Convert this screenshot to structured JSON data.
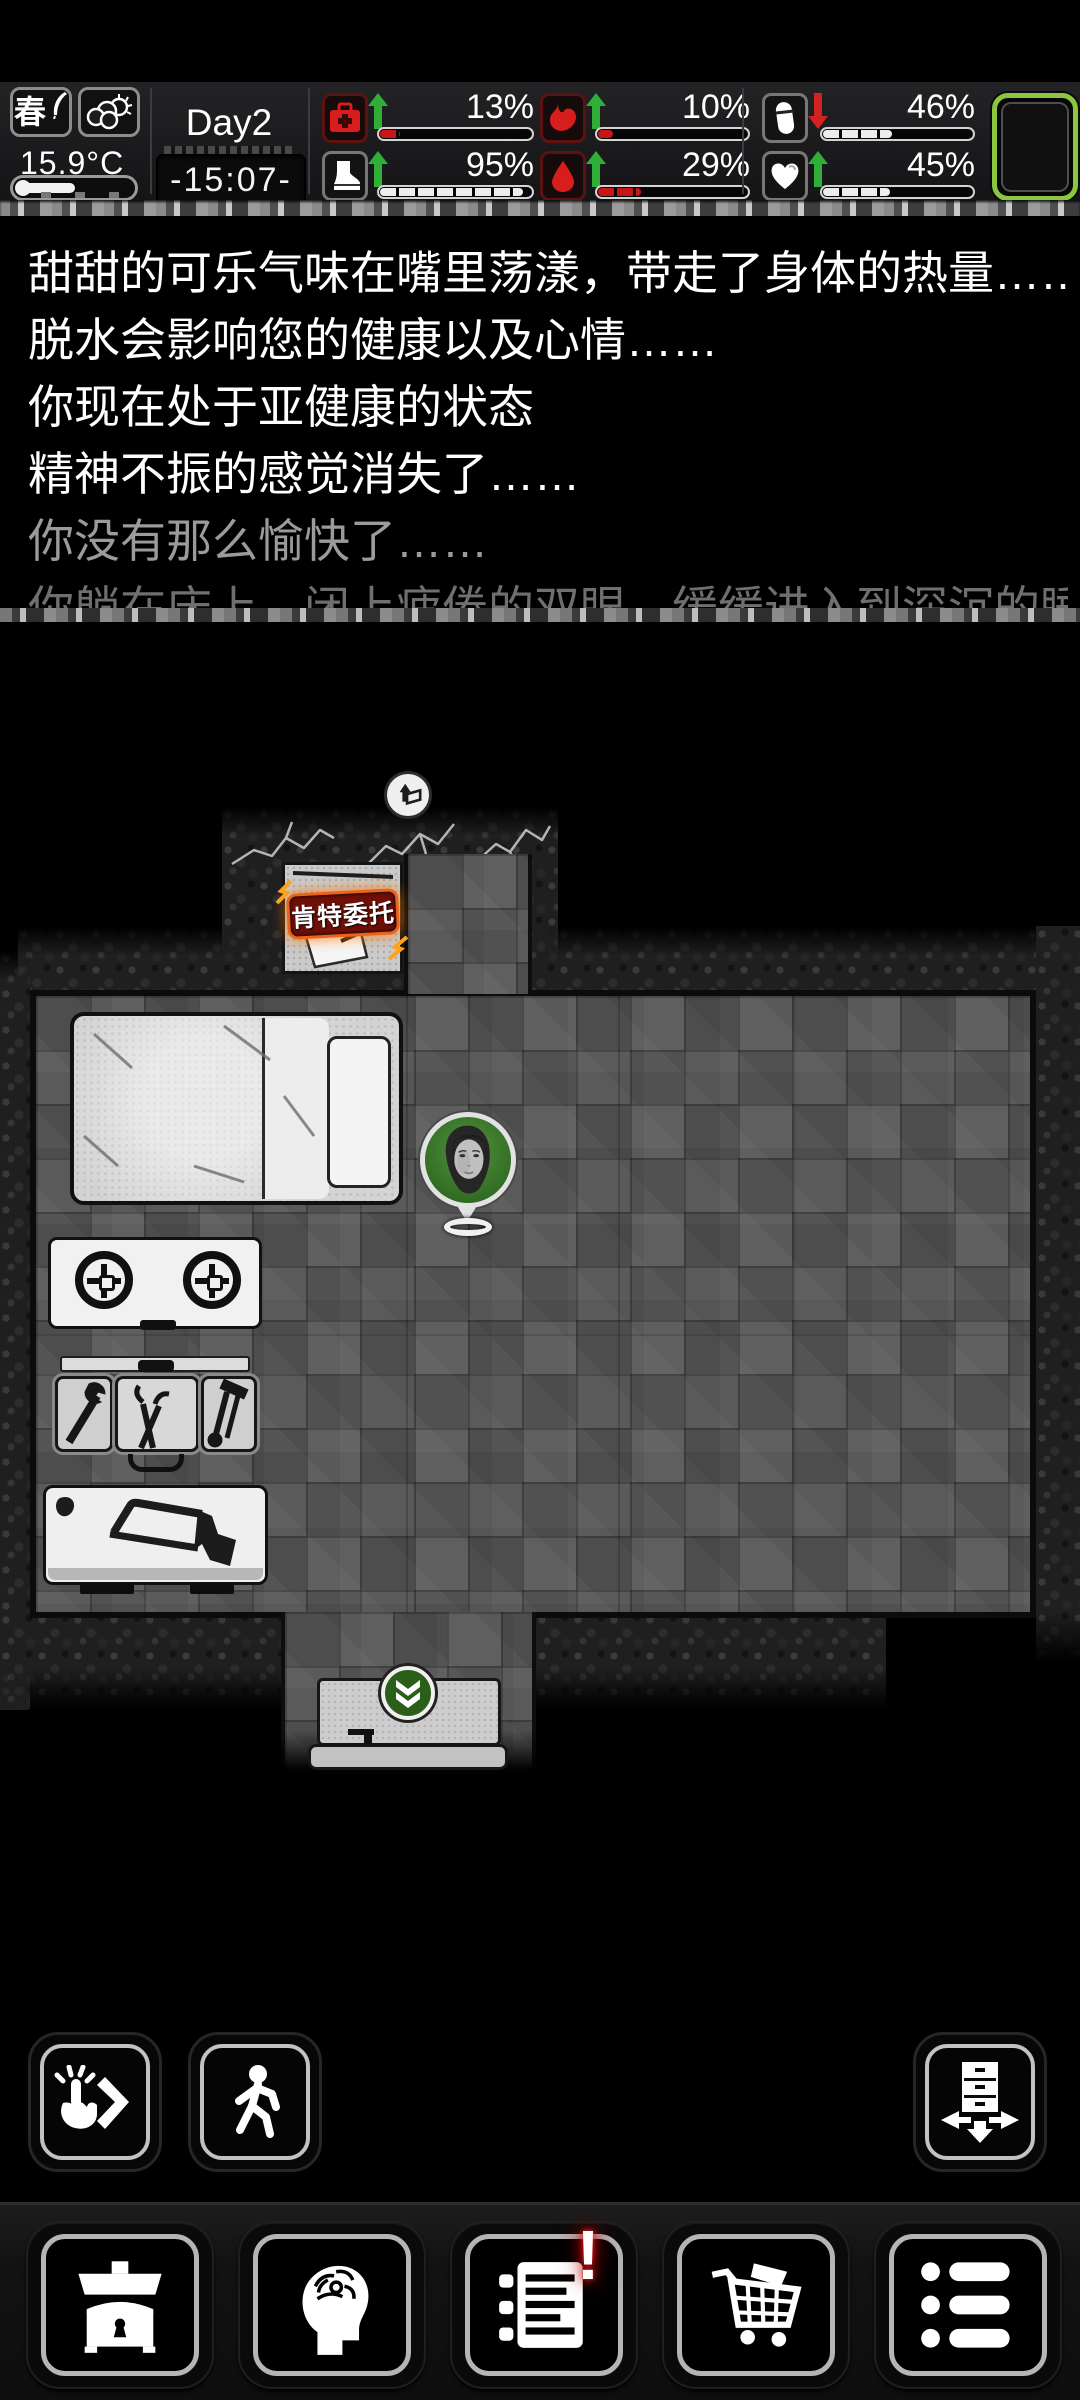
{
  "hud": {
    "season_label": "春",
    "weather_icon": "partly-cloudy-icon",
    "temperature": "15.9°C",
    "day_label": "Day2",
    "time_label": "-15:07-",
    "stats": [
      {
        "name": "health",
        "icon": "first-aid-kit-icon",
        "trend": "up",
        "value": "13%",
        "pct": 13,
        "tone": "red"
      },
      {
        "name": "stamina",
        "icon": "boot-icon",
        "trend": "up",
        "value": "95%",
        "pct": 95,
        "tone": "white"
      },
      {
        "name": "fullness",
        "icon": "stomach-icon",
        "trend": "up",
        "value": "10%",
        "pct": 10,
        "tone": "red"
      },
      {
        "name": "hydration",
        "icon": "blood-drop-icon",
        "trend": "up",
        "value": "29%",
        "pct": 29,
        "tone": "red"
      },
      {
        "name": "medicine",
        "icon": "capsule-icon",
        "trend": "down",
        "value": "46%",
        "pct": 46,
        "tone": "white"
      },
      {
        "name": "mood",
        "icon": "heart-icon",
        "trend": "up",
        "value": "45%",
        "pct": 45,
        "tone": "white"
      }
    ]
  },
  "log": {
    "lines": [
      {
        "text": "甜甜的可乐气味在嘴里荡漾，带走了身体的热量……",
        "tone": "bright"
      },
      {
        "text": "脱水会影响您的健康以及心情……",
        "tone": "bright"
      },
      {
        "text": "你现在处于亚健康的状态",
        "tone": "bright"
      },
      {
        "text": "精神不振的感觉消失了……",
        "tone": "bright"
      },
      {
        "text": "你没有那么愉快了……",
        "tone": "dim"
      },
      {
        "text": "你躺在床上，闭上疲倦的双眼，缓缓进入到深沉的睡眠中",
        "tone": "dimmer"
      }
    ]
  },
  "map": {
    "quest_marker_label": "肯特委托",
    "exit_top": "exit-up-marker",
    "exit_bottom": "exit-down-marker",
    "objects": [
      "bed",
      "stove",
      "workbench",
      "saw-table",
      "player-character"
    ]
  },
  "toolbar": {
    "interact": "tap-interact-button",
    "move": "walk-button",
    "deploy": "deploy-furniture-button"
  },
  "navbar": {
    "items": [
      "inventory-chest",
      "character-mind",
      "journal",
      "shop-cart",
      "menu-list"
    ],
    "journal_alert": "!"
  },
  "colors": {
    "stat_red": "#c81616",
    "stat_white": "#ededed",
    "trend_up": "#2fae38",
    "trend_down": "#d32222",
    "battery_green": "#8cc63e",
    "quest_badge_bg": "#6e0f08",
    "quest_badge_border": "#e8641c",
    "exit_green": "#2b5e18",
    "alert_red": "#d00000"
  }
}
